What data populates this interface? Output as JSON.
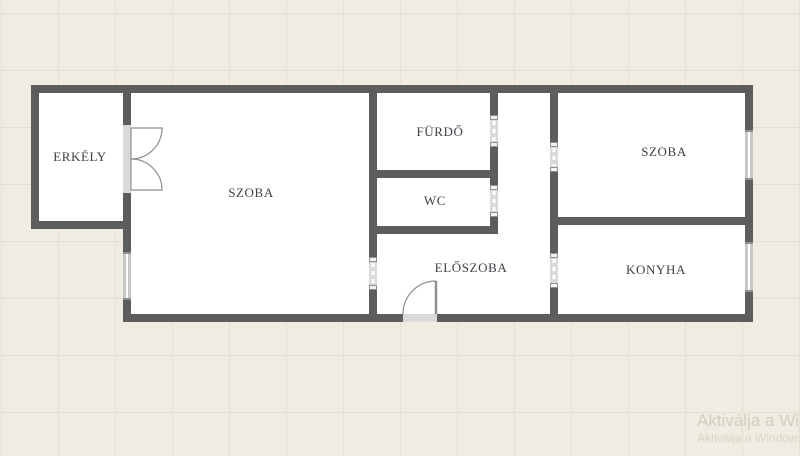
{
  "floorplan": {
    "rooms": [
      {
        "id": "erkely",
        "label": "ERKÉLY"
      },
      {
        "id": "szoba-left",
        "label": "SZOBA"
      },
      {
        "id": "furdo",
        "label": "FÜRDŐ"
      },
      {
        "id": "wc",
        "label": "WC"
      },
      {
        "id": "eloszoba",
        "label": "ELŐSZOBA"
      },
      {
        "id": "szoba-right",
        "label": "SZOBA"
      },
      {
        "id": "konyha",
        "label": "KONYHA"
      }
    ],
    "colors": {
      "wall": "#5d5d5d",
      "background": "#f1ece1",
      "grid_line": "#e5e0d3",
      "room_fill": "#ffffff",
      "door_frame": "#d9d9d9",
      "window_frame": "#c6c6c6",
      "window_glass": "#ffffff",
      "label_text": "#3e4148",
      "swing_stroke": "#8f8f8f"
    }
  },
  "watermark": {
    "line1": "Aktiválja a Win",
    "line2": "Aktiválja a Windows"
  }
}
